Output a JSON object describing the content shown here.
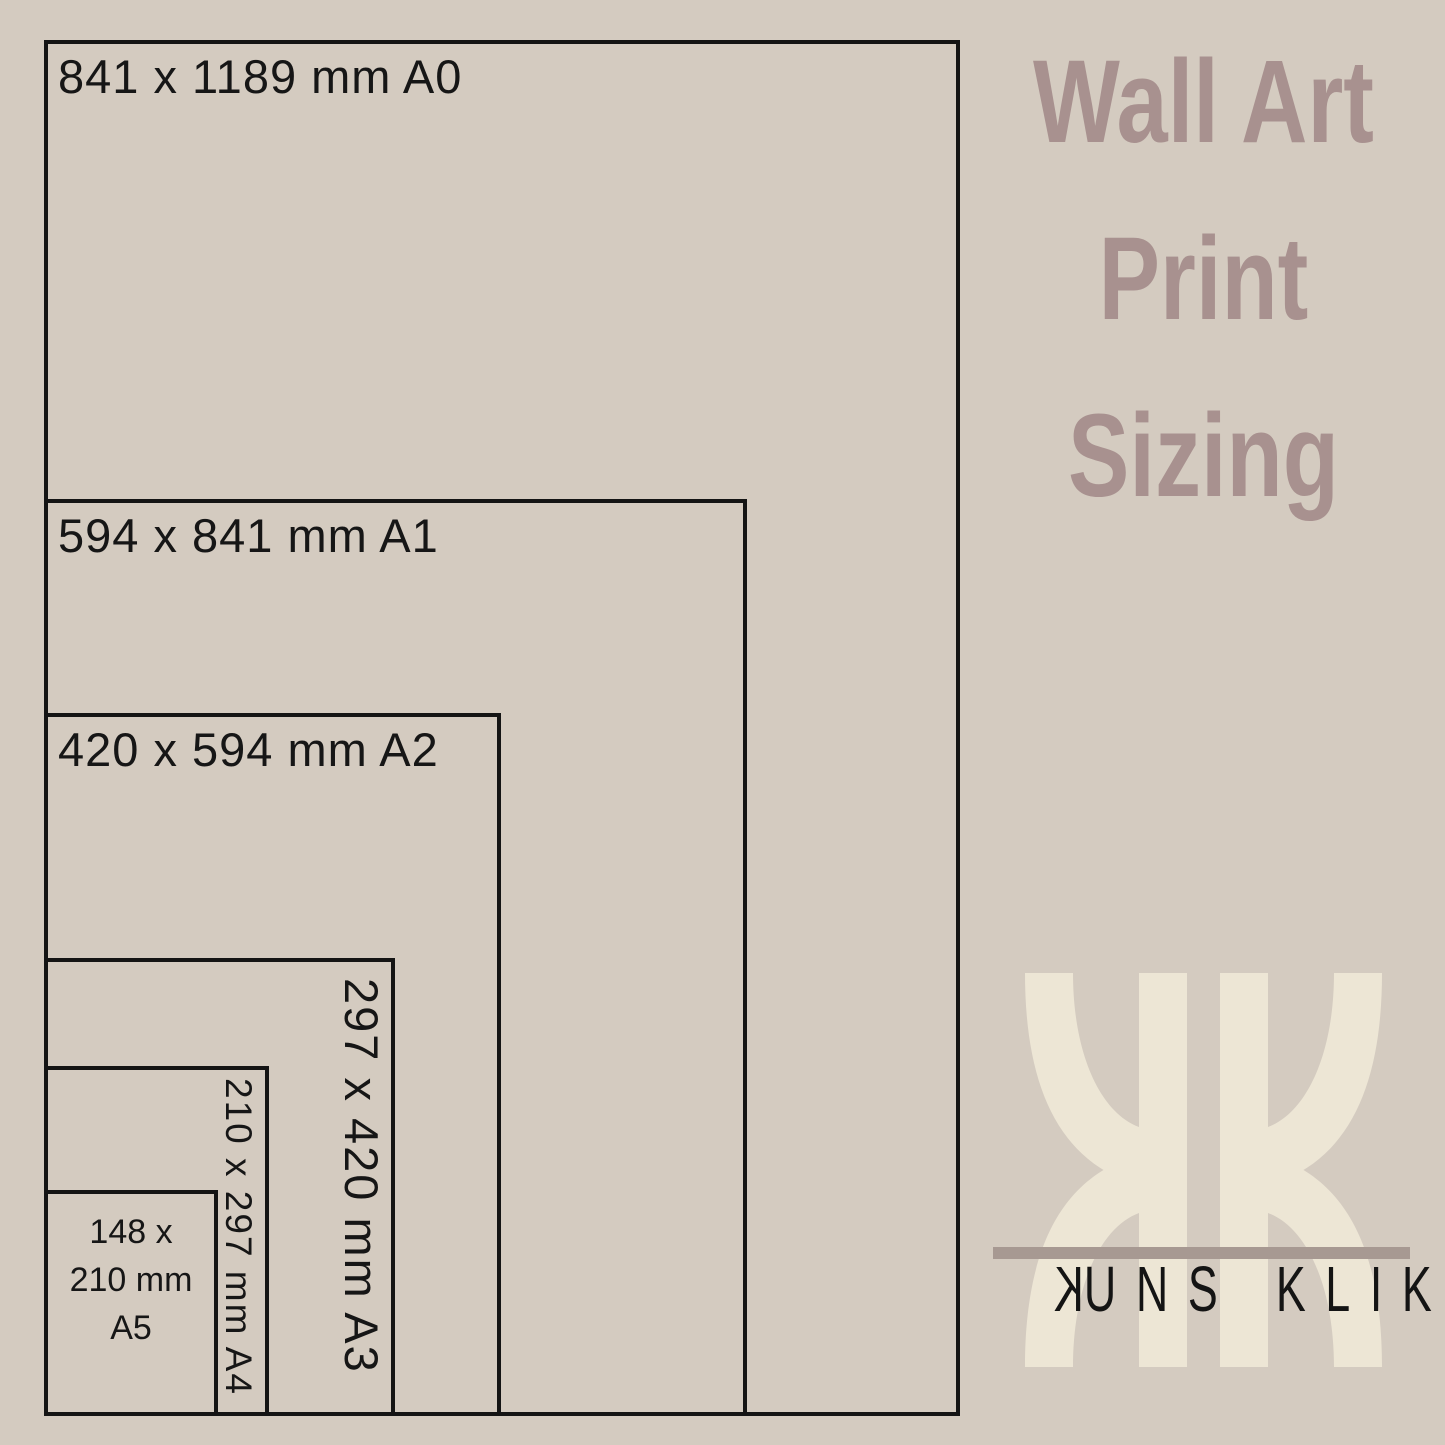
{
  "colors": {
    "background": "#d4cbc0",
    "box_line": "#141414",
    "label_text": "#161616",
    "title_text": "#a8918f",
    "logo_cream": "#ede6d5",
    "logo_bar": "#a79992",
    "wordmark_text": "#141414"
  },
  "diagram": {
    "boxes": [
      {
        "id": "A0",
        "label": "841 x 1189 mm A0",
        "orientation": "horizontal"
      },
      {
        "id": "A1",
        "label": "594 x 841 mm A1",
        "orientation": "horizontal"
      },
      {
        "id": "A2",
        "label": "420 x 594 mm A2",
        "orientation": "horizontal"
      },
      {
        "id": "A3",
        "label": "297 x 420 mm A3",
        "orientation": "vertical"
      },
      {
        "id": "A4",
        "label": "210 x 297 mm A4",
        "orientation": "vertical"
      },
      {
        "id": "A5",
        "label_lines": [
          "148 x",
          "210 mm",
          "A5"
        ]
      }
    ]
  },
  "title": {
    "lines": [
      "Wall Art",
      "Print",
      "Sizing"
    ]
  },
  "logo": {
    "monogram": "KK",
    "wordmark": {
      "first_letter": "K",
      "first_rest": "UNS",
      "second": "KLIK"
    }
  }
}
